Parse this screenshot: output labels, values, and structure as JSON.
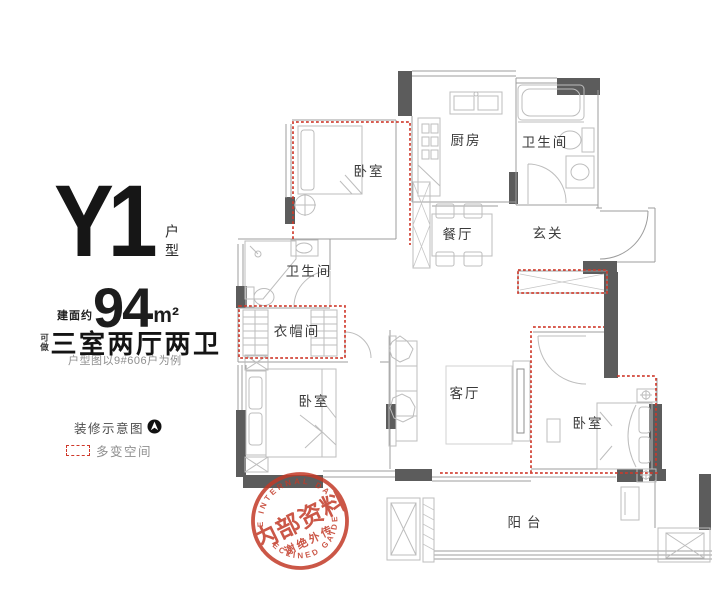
{
  "panel": {
    "unit_name": "Y1",
    "unit_type": "户型",
    "area_prefix": "建面约",
    "area_value": "94",
    "area_unit": "m²",
    "layout_prefix": "可做",
    "layout": "三室两厅两卫",
    "note": "户型图以9#606户为例",
    "legend_decor_label": "装修示意图",
    "legend_flex_label": "多变空间"
  },
  "rooms": {
    "bedroom_top": "卧室",
    "kitchen": "厨房",
    "bath_top": "卫生间",
    "dining": "餐厅",
    "foyer": "玄关",
    "bath_mid": "卫生间",
    "cloakroom": "衣帽间",
    "bedroom_left": "卧室",
    "living": "客厅",
    "bedroom_right": "卧室",
    "balcony": "阳台"
  },
  "stamp": {
    "arc_top": "THE INTERNAL DATA",
    "main": "内部资料",
    "sub": "谢绝外传",
    "arc_bottom": "DECLINED GAIDES"
  },
  "colors": {
    "wall": "#5c5c5c",
    "line": "#9c9c9c",
    "furniture": "#bdbdbd",
    "flex_dashed": "#cf382a",
    "stamp_red": "#c23a28",
    "ink": "#1d1d1d",
    "muted": "#8f8f8f"
  }
}
